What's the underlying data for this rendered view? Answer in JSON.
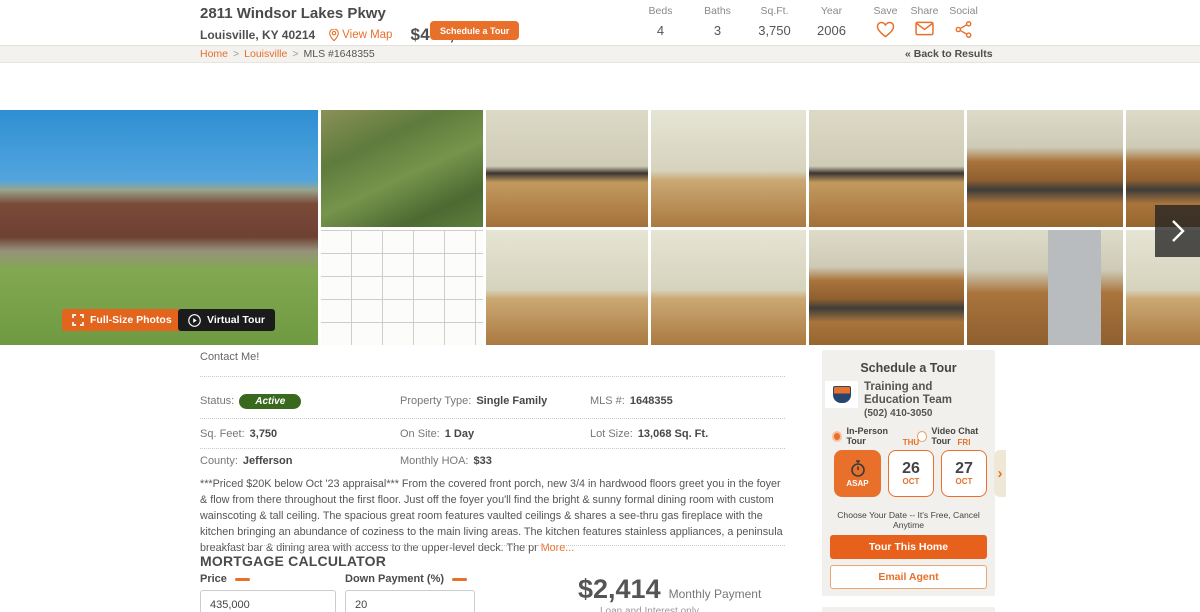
{
  "header": {
    "title": "2811 Windsor Lakes Pkwy",
    "location": "Louisville, KY 40214",
    "view_map": "View Map",
    "price": "$435,000",
    "schedule_button": "Schedule a Tour",
    "stats": [
      {
        "label": "Beds",
        "value": "4"
      },
      {
        "label": "Baths",
        "value": "3"
      },
      {
        "label": "Sq.Ft.",
        "value": "3,750"
      },
      {
        "label": "Year",
        "value": "2006"
      }
    ],
    "actions": [
      {
        "label": "Save",
        "icon": "heart-icon"
      },
      {
        "label": "Share",
        "icon": "envelope-icon"
      },
      {
        "label": "Social",
        "icon": "share-nodes-icon"
      }
    ]
  },
  "breadcrumb": {
    "home": "Home",
    "city": "Louisville",
    "mls": "MLS #1648355",
    "separator": ">",
    "back": "« Back to Results"
  },
  "gallery": {
    "full_size_button": "Full-Size Photos",
    "virtual_tour_button": "Virtual Tour",
    "photos": [
      "house-front-exterior",
      "aerial-view",
      "floor-plan",
      "foyer-front-door",
      "living-room-furnished",
      "great-room-windows",
      "family-room-ceiling-fan",
      "see-thru-fireplace",
      "empty-room-ceiling-fan",
      "kitchen-counters",
      "kitchen-range",
      "kitchen-refrigerator-1",
      "kitchen-refrigerator-2",
      "kitchen-cabinets-partial",
      "breakfast-area-partial"
    ]
  },
  "details": {
    "contact_me": "Contact Me!",
    "fields": [
      {
        "label": "Status:",
        "value": "Active"
      },
      {
        "label": "Property Type:",
        "value": "Single Family"
      },
      {
        "label": "MLS #:",
        "value": "1648355"
      },
      {
        "label": "Sq. Feet:",
        "value": "3,750"
      },
      {
        "label": "On Site:",
        "value": "1 Day"
      },
      {
        "label": "Lot Size:",
        "value": "13,068 Sq. Ft."
      },
      {
        "label": "County:",
        "value": "Jefferson"
      },
      {
        "label": "Monthly HOA:",
        "value": "$33"
      }
    ],
    "description": "***Priced $20K below Oct '23 appraisal*** From the covered front porch, new 3/4 in hardwood floors greet you in the foyer & flow from there throughout the first floor. Just off the foyer you'll find the bright & sunny formal dining room with custom wainscoting & tall ceiling. The spacious great room features vaulted ceilings & shares a see-thru gas fireplace with the kitchen bringing an abundance of coziness to the main living areas. The kitchen features stainless appliances, a peninsula breakfast bar & dining area with access to the upper-level deck. The pr",
    "more_link": "More..."
  },
  "mortgage": {
    "heading": "MORTGAGE CALCULATOR",
    "price_label": "Price",
    "price_value": "435,000",
    "down_label": "Down Payment (%)",
    "down_value": "20",
    "monthly_value": "$2,414",
    "monthly_label": "Monthly Payment",
    "sub_note": "Loan and Interest only"
  },
  "tour": {
    "heading": "Schedule a Tour",
    "agent_name": "Training and Education Team",
    "agent_phone": "(502) 410-3050",
    "option_in_person": "In-Person Tour",
    "option_video": "Video Chat Tour",
    "asap_label": "ASAP",
    "dates": [
      {
        "day": "THU",
        "num": "26",
        "month": "OCT"
      },
      {
        "day": "FRI",
        "num": "27",
        "month": "OCT"
      }
    ],
    "next_arrow": "›",
    "note": "Choose Your Date -- It's Free, Cancel Anytime",
    "tour_button": "Tour This Home",
    "email_button": "Email Agent"
  },
  "colors": {
    "accent_orange": "#E8702A",
    "badge_green": "#38691E",
    "text_dark": "#4A4A4A"
  }
}
